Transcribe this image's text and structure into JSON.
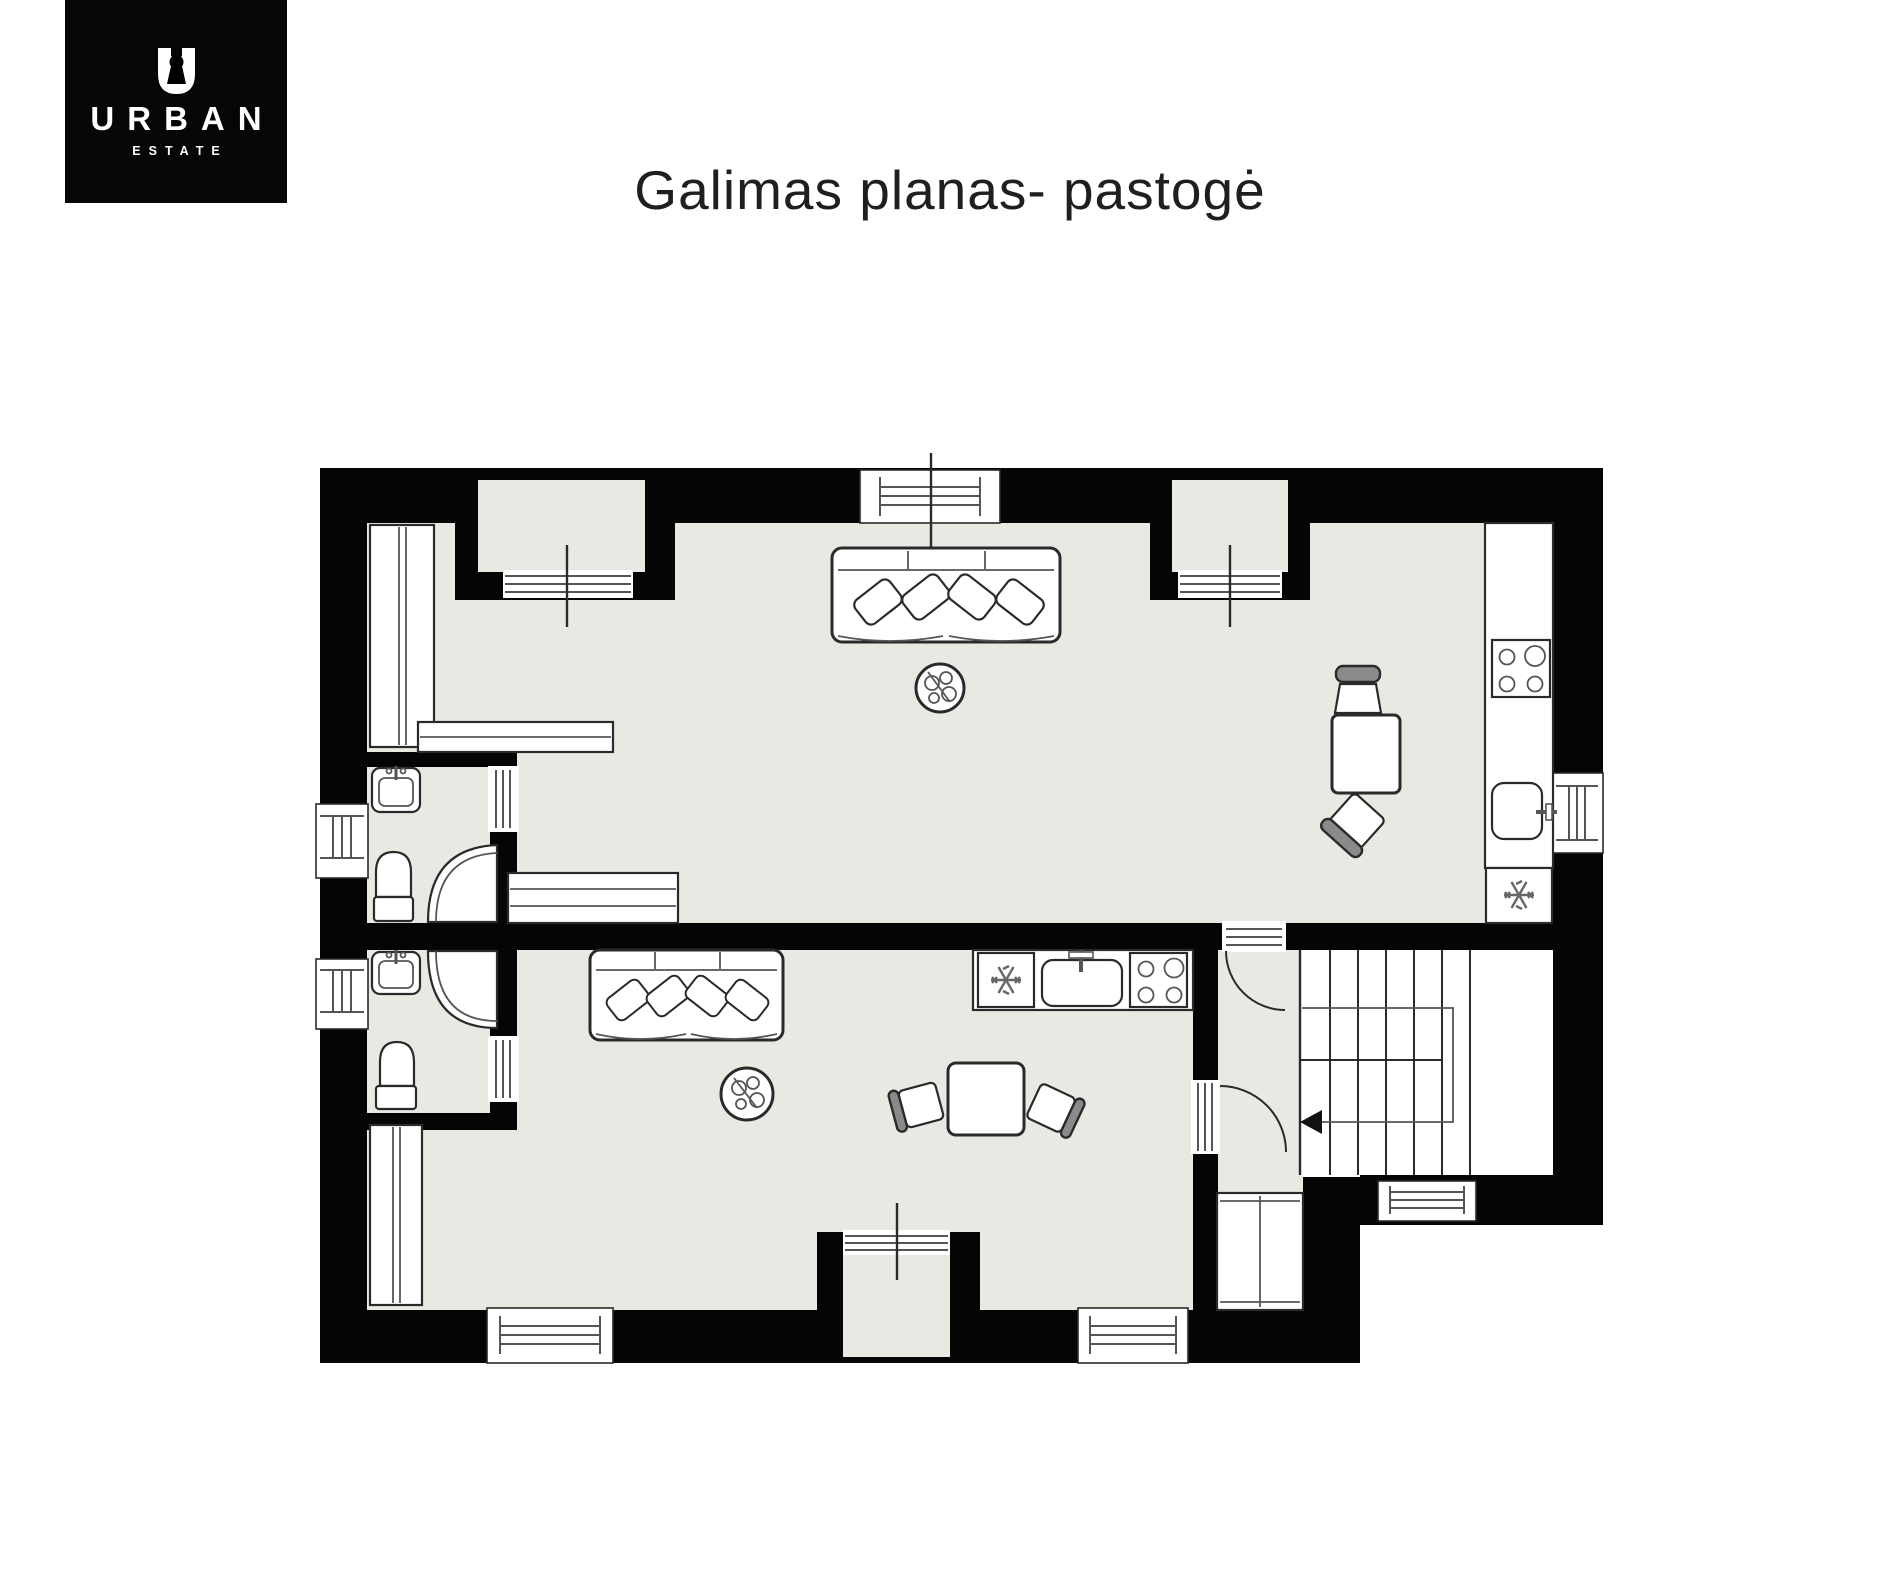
{
  "logo": {
    "brand": "URBAN",
    "sub": "ESTATE",
    "icon": "keyhole-u-icon"
  },
  "title": {
    "text": "Galimas planas- pastogė"
  },
  "colors": {
    "page": "#ffffff",
    "wall": "#050505",
    "floor": "#e9e9e4",
    "line": "#2a2a2a",
    "lineSoft": "#555555",
    "chairBack": "#8a8a8a",
    "title": "#1f1f1f",
    "logoBg": "#060606",
    "logoFg": "#ffffff"
  },
  "floorplan": {
    "description": "attic floor plan with two living units, shared stair hall",
    "fixtures": [
      "window",
      "dormer-niche-window",
      "interior-door",
      "door-swing-arc",
      "sofa",
      "pillow",
      "plant",
      "wardrobe",
      "sideboard",
      "bench-bed",
      "desk",
      "chair",
      "dining-table",
      "kitchen-counter",
      "stove-burners",
      "kitchen-sink",
      "fridge-snowflake",
      "bathroom-sink",
      "toilet",
      "corner-shower",
      "staircase",
      "walk-line",
      "direction-arrow",
      "entry-closet"
    ]
  }
}
